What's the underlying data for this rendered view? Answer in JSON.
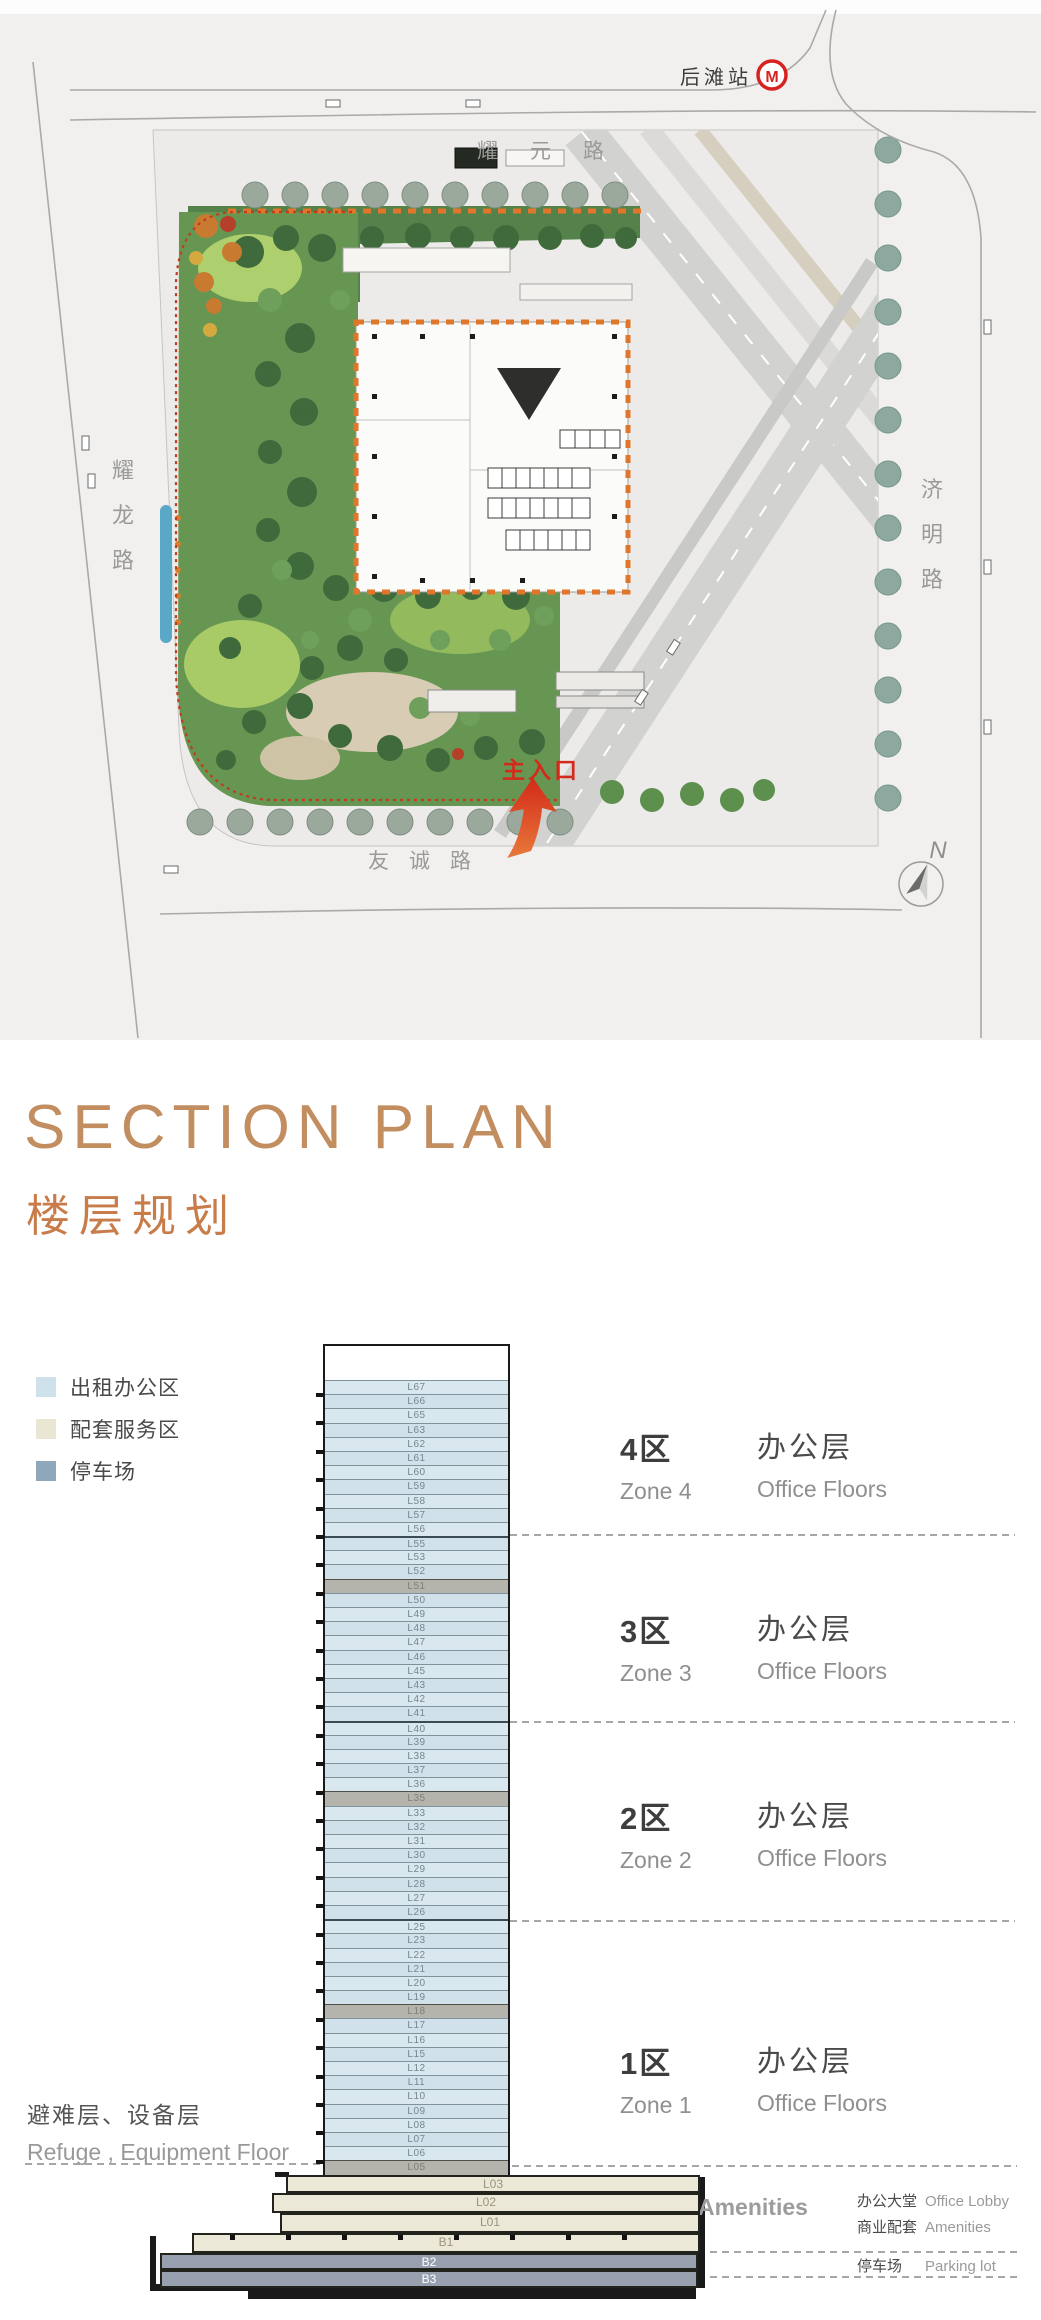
{
  "site_plan": {
    "station_label": "后滩站",
    "metro_logo": "M",
    "roads": {
      "top": "耀元路",
      "bottom": "友诚路",
      "left_chars": [
        "耀",
        "龙",
        "路"
      ],
      "right_chars": [
        "济",
        "明",
        "路"
      ]
    },
    "main_entrance_label": "主入口",
    "north_label": "N",
    "colors": {
      "metro_red": "#d6231f",
      "entrance_red": "#d42a1c",
      "footprint_boundary_orange": "#e0762a",
      "site_redline": "#c43a20"
    }
  },
  "section": {
    "title": "SECTION PLAN",
    "subtitle": "楼层规划",
    "title_color": "#c28e60",
    "legend": [
      {
        "label": "出租办公区",
        "color": "#cfe2ec"
      },
      {
        "label": "配套服务区",
        "color": "#e9e7d4"
      },
      {
        "label": "停车场",
        "color": "#8ea7ba"
      }
    ],
    "zones": [
      {
        "zh": "4区",
        "en": "Zone 4",
        "type_zh": "办公层",
        "type_en": "Office Floors"
      },
      {
        "zh": "3区",
        "en": "Zone 3",
        "type_zh": "办公层",
        "type_en": "Office Floors"
      },
      {
        "zh": "2区",
        "en": "Zone 2",
        "type_zh": "办公层",
        "type_en": "Office Floors"
      },
      {
        "zh": "1区",
        "en": "Zone 1",
        "type_zh": "办公层",
        "type_en": "Office Floors"
      }
    ],
    "refuge_note": {
      "zh": "避难层、设备层",
      "en": "Refuge , Equipment Floor"
    },
    "podium_callout": {
      "zh": "配套服务区",
      "en": "Amenities"
    },
    "annotations": [
      {
        "zh": "办公大堂",
        "en": "Office Lobby"
      },
      {
        "zh": "商业配套",
        "en": "Amenities"
      },
      {
        "zh": "停车场",
        "en": "Parking lot"
      }
    ],
    "floors": [
      {
        "label": "L67",
        "type": "office"
      },
      {
        "label": "L66",
        "type": "office"
      },
      {
        "label": "L65",
        "type": "office"
      },
      {
        "label": "L63",
        "type": "office"
      },
      {
        "label": "L62",
        "type": "office"
      },
      {
        "label": "L61",
        "type": "office"
      },
      {
        "label": "L60",
        "type": "office"
      },
      {
        "label": "L59",
        "type": "office"
      },
      {
        "label": "L58",
        "type": "office"
      },
      {
        "label": "L57",
        "type": "office"
      },
      {
        "label": "L56",
        "type": "office"
      },
      {
        "label": "L55",
        "type": "office"
      },
      {
        "label": "L53",
        "type": "office"
      },
      {
        "label": "L52",
        "type": "office"
      },
      {
        "label": "L51",
        "type": "refuge"
      },
      {
        "label": "L50",
        "type": "office"
      },
      {
        "label": "L49",
        "type": "office"
      },
      {
        "label": "L48",
        "type": "office"
      },
      {
        "label": "L47",
        "type": "office"
      },
      {
        "label": "L46",
        "type": "office"
      },
      {
        "label": "L45",
        "type": "office"
      },
      {
        "label": "L43",
        "type": "office"
      },
      {
        "label": "L42",
        "type": "office"
      },
      {
        "label": "L41",
        "type": "office"
      },
      {
        "label": "L40",
        "type": "office"
      },
      {
        "label": "L39",
        "type": "office"
      },
      {
        "label": "L38",
        "type": "office"
      },
      {
        "label": "L37",
        "type": "office"
      },
      {
        "label": "L36",
        "type": "office"
      },
      {
        "label": "L35",
        "type": "refuge"
      },
      {
        "label": "L33",
        "type": "office"
      },
      {
        "label": "L32",
        "type": "office"
      },
      {
        "label": "L31",
        "type": "office"
      },
      {
        "label": "L30",
        "type": "office"
      },
      {
        "label": "L29",
        "type": "office"
      },
      {
        "label": "L28",
        "type": "office"
      },
      {
        "label": "L27",
        "type": "office"
      },
      {
        "label": "L26",
        "type": "office"
      },
      {
        "label": "L25",
        "type": "office"
      },
      {
        "label": "L23",
        "type": "office"
      },
      {
        "label": "L22",
        "type": "office"
      },
      {
        "label": "L21",
        "type": "office"
      },
      {
        "label": "L20",
        "type": "office"
      },
      {
        "label": "L19",
        "type": "office"
      },
      {
        "label": "L18",
        "type": "refuge"
      },
      {
        "label": "L17",
        "type": "office"
      },
      {
        "label": "L16",
        "type": "office"
      },
      {
        "label": "L15",
        "type": "office"
      },
      {
        "label": "L12",
        "type": "office"
      },
      {
        "label": "L11",
        "type": "office"
      },
      {
        "label": "L10",
        "type": "office"
      },
      {
        "label": "L09",
        "type": "office"
      },
      {
        "label": "L08",
        "type": "office"
      },
      {
        "label": "L07",
        "type": "office"
      },
      {
        "label": "L06",
        "type": "office"
      },
      {
        "label": "L05",
        "type": "refuge"
      }
    ],
    "podium": [
      {
        "label": "L03",
        "type": "amenity"
      },
      {
        "label": "L02",
        "type": "amenity"
      },
      {
        "label": "L01",
        "type": "amenity"
      },
      {
        "label": "B1",
        "type": "amenity"
      },
      {
        "label": "B2",
        "type": "parking"
      },
      {
        "label": "B3",
        "type": "parking"
      }
    ]
  }
}
